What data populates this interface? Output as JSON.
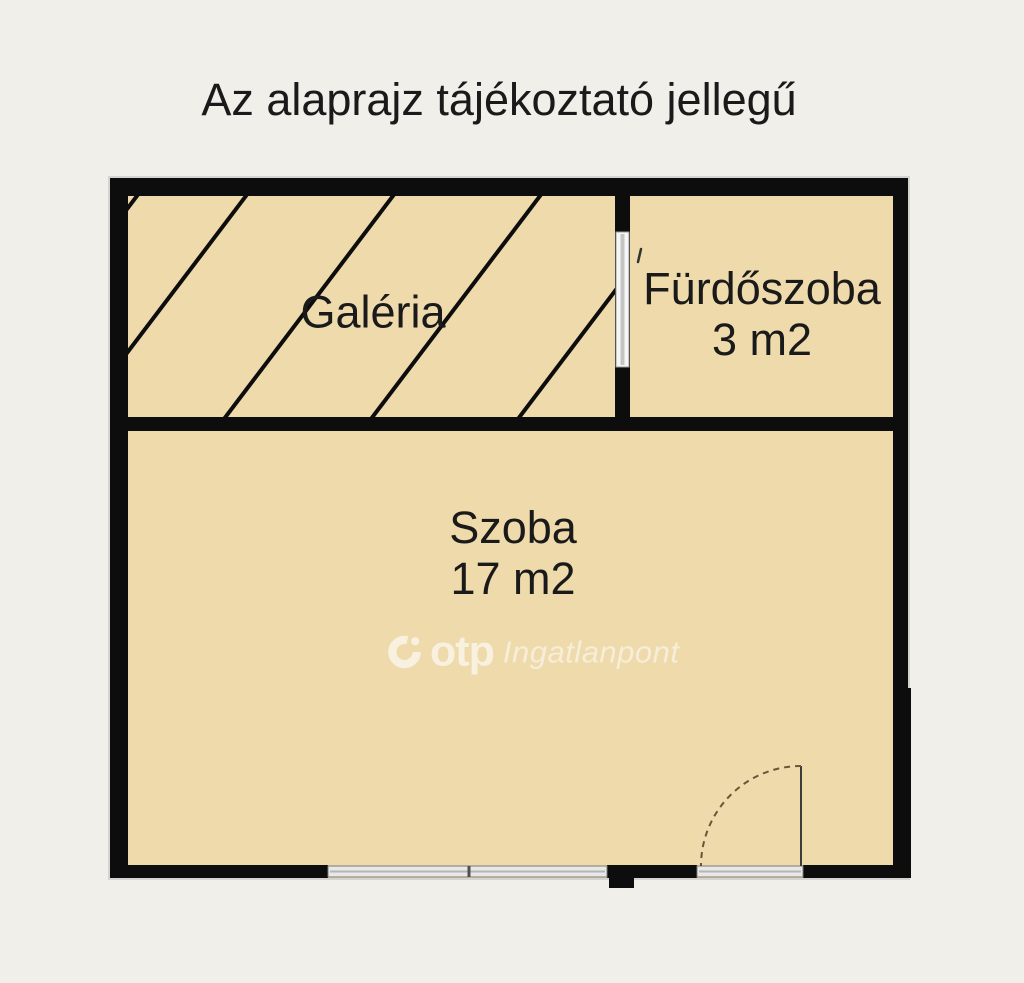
{
  "title": "Az alaprajz tájékoztató jellegű",
  "rooms": {
    "galeria": {
      "label": "Galéria"
    },
    "furdoszoba": {
      "label": "Fürdőszoba",
      "area": "3 m2"
    },
    "szoba": {
      "label": "Szoba",
      "area": "17 m2"
    }
  },
  "watermark": {
    "brand": "otp",
    "suffix": "Ingatlanpont"
  },
  "colors": {
    "background": "#f0efe9",
    "floor": "#eedaab",
    "wall": "#0d0d0d",
    "window": "#e8e8e8",
    "text": "#1a1a1a"
  }
}
